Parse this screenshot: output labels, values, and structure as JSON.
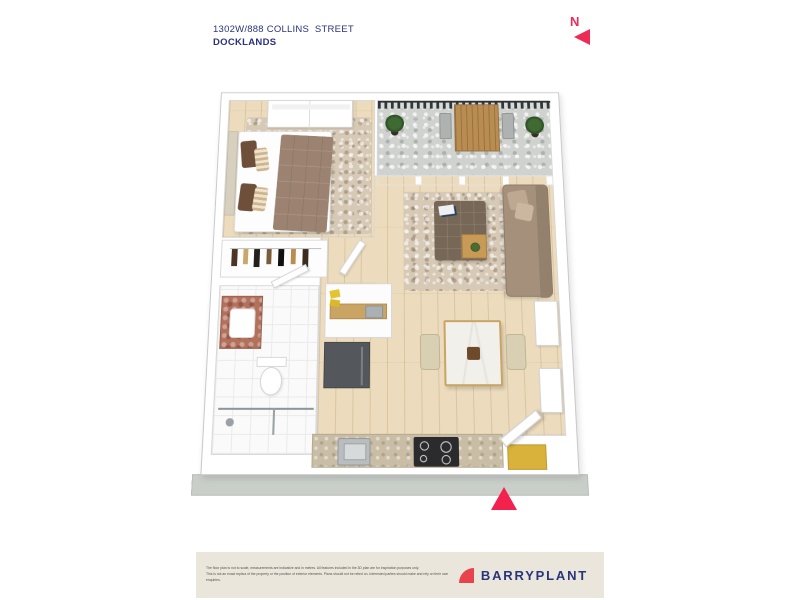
{
  "header": {
    "address": "1302W/888 COLLINS  STREET",
    "suburb": "DOCKLANDS"
  },
  "north_indicator": {
    "label": "N"
  },
  "footer": {
    "disclaimer_line1": "The floor plan is not to scale, measurements are indicative and in metres. All features included in the 3D plan are for inspiration purposes only.",
    "disclaimer_line2": "This is not an exact replica of the property or the position of exterior elements. Plans should not be relied on. Interested parties should make and rely on their own enquiries.",
    "brand_name": "BARRYPLANT"
  },
  "colors": {
    "accent_pink": "#F3214E",
    "north_arrow_red": "#EE2B55",
    "logo_mark_red": "#E8434C",
    "navy_text": "#2A3380",
    "footer_background": "#EBE6DC",
    "plinth_gray": "#C9CEC9",
    "timber_floor": "#ECDCBD"
  }
}
